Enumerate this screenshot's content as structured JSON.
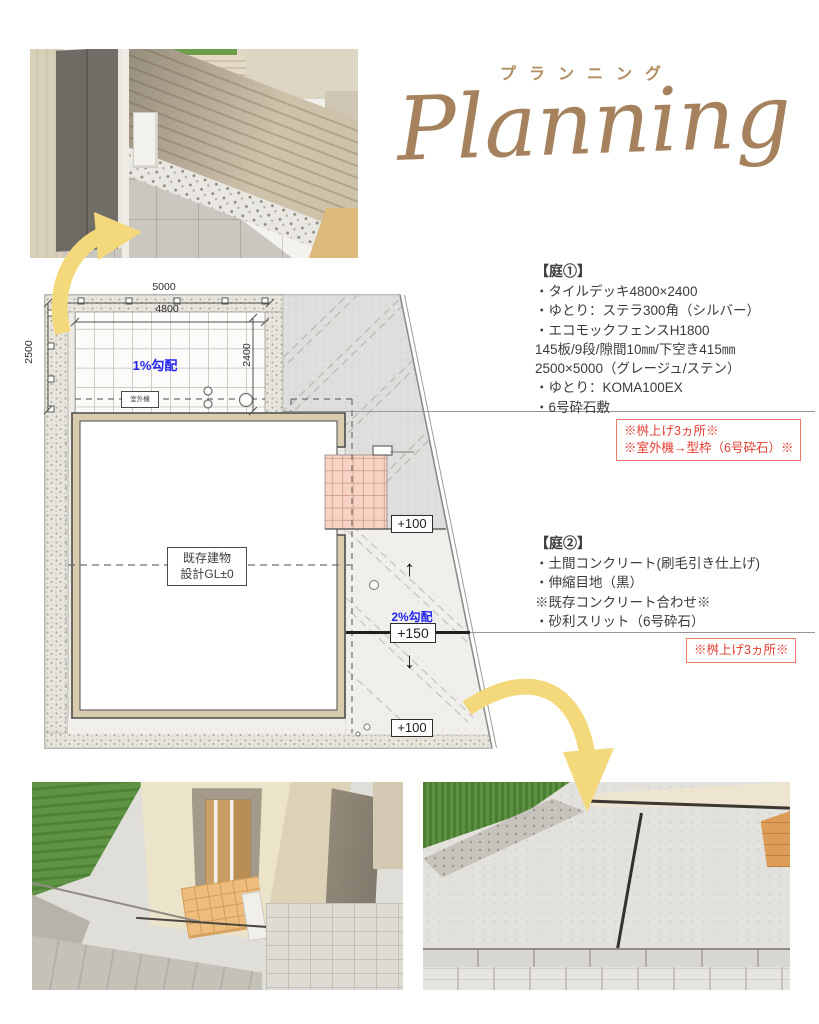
{
  "title": {
    "katakana": "プランニング",
    "script": "Planning"
  },
  "garden1": {
    "heading": "【庭①】",
    "lines": [
      "・タイルデッキ4800×2400",
      "・ゆとり：ステラ300角（シルバー）",
      "・エコモックフェンスH1800",
      "145板/9段/隙間10㎜/下空き415㎜",
      "2500×5000（グレージュ/ステン）",
      "・ゆとり：KOMA100EX",
      "・6号砕石敷"
    ]
  },
  "note1": {
    "line1": "※桝上げ3ヵ所※",
    "line2": "※室外機→型枠（6号砕石）※"
  },
  "garden2": {
    "heading": "【庭②】",
    "lines": [
      "・土間コンクリート(刷毛引き仕上げ)",
      "・伸縮目地（黒）",
      "※既存コンクリート合わせ※",
      "・砂利スリット（6号砕石）"
    ]
  },
  "note2": {
    "line1": "※桝上げ3ヵ所※"
  },
  "plan": {
    "dim_top": "5000",
    "dim_top_inner": "4800",
    "dim_left": "2500",
    "dim_right_inner": "2400",
    "slope_deck": "1%勾配",
    "outdoor_unit": "室外機",
    "building": {
      "line1": "既存建物",
      "line2": "設計GL±0"
    },
    "level_upper": "+100",
    "slope_yard": "2%勾配",
    "level_mid": "+150",
    "level_lower": "+100",
    "arrow_up": "↑",
    "arrow_down": "↓"
  },
  "colors": {
    "accent_brown": "#a5825d",
    "note_red": "#e43c30",
    "slope_blue": "#2323f0",
    "arrow_yellow": "#f3d97c"
  }
}
